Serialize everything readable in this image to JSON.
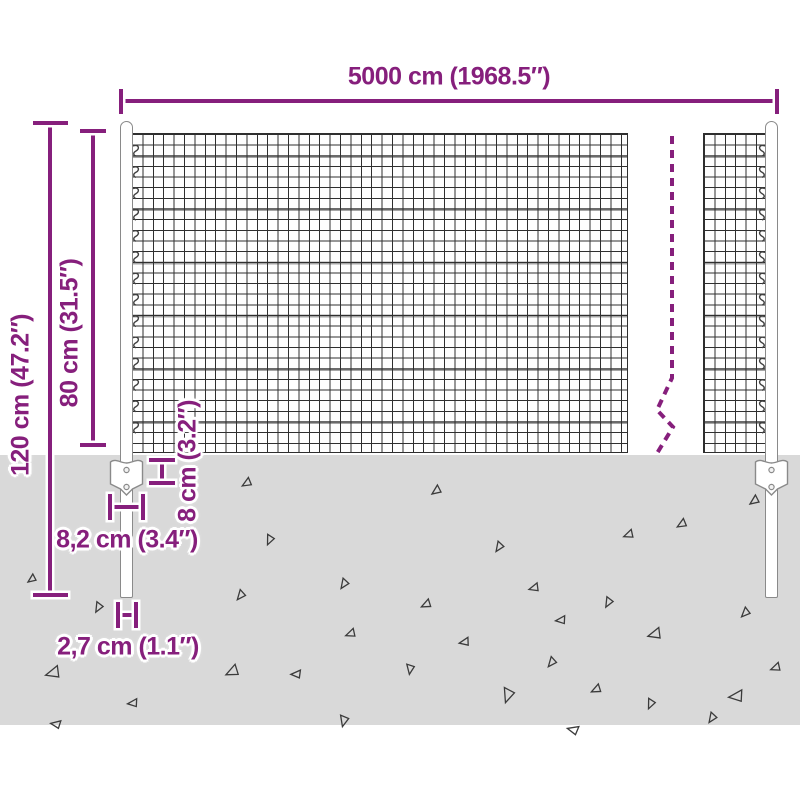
{
  "diagram": {
    "type": "product-dimension-diagram",
    "subject": "wire mesh fence with posts and anchor plates",
    "accent_color": "#861F7C",
    "ground_color": "#D9D9D9",
    "mesh_line_color": "#2F2F2F"
  },
  "labels": {
    "total_width": "5000 cm (1968.5″)",
    "post_height": "120 cm (47.2″)",
    "fence_height": "80 cm (31.5″)",
    "plate_height": "8 cm (3.2″)",
    "plate_width": "8,2 cm (3.4″)",
    "post_width": "2,7 cm (1.1″)"
  },
  "ground": {
    "triangles": [
      {
        "x": 28,
        "y": 574,
        "s": 8,
        "r": 0
      },
      {
        "x": 50,
        "y": 663,
        "s": 13,
        "r": 20
      },
      {
        "x": 57,
        "y": 717,
        "s": 9,
        "r": 45
      },
      {
        "x": 92,
        "y": 604,
        "s": 9,
        "r": -25
      },
      {
        "x": 132,
        "y": 696,
        "s": 9,
        "r": 30
      },
      {
        "x": 228,
        "y": 663,
        "s": 12,
        "r": 10
      },
      {
        "x": 235,
        "y": 591,
        "s": 9,
        "r": -15
      },
      {
        "x": 243,
        "y": 477,
        "s": 9,
        "r": 5
      },
      {
        "x": 263,
        "y": 537,
        "s": 9,
        "r": -30
      },
      {
        "x": 296,
        "y": 667,
        "s": 9,
        "r": 35
      },
      {
        "x": 338,
        "y": 580,
        "s": 9,
        "r": -20
      },
      {
        "x": 348,
        "y": 627,
        "s": 9,
        "r": 15
      },
      {
        "x": 336,
        "y": 719,
        "s": 10,
        "r": -40
      },
      {
        "x": 403,
        "y": 668,
        "s": 9,
        "r": -45
      },
      {
        "x": 423,
        "y": 598,
        "s": 9,
        "r": 10
      },
      {
        "x": 432,
        "y": 485,
        "s": 9,
        "r": 0
      },
      {
        "x": 463,
        "y": 635,
        "s": 9,
        "r": 25
      },
      {
        "x": 493,
        "y": 543,
        "s": 9,
        "r": -20
      },
      {
        "x": 498,
        "y": 692,
        "s": 13,
        "r": -35
      },
      {
        "x": 532,
        "y": 581,
        "s": 9,
        "r": 20
      },
      {
        "x": 546,
        "y": 658,
        "s": 9,
        "r": -15
      },
      {
        "x": 560,
        "y": 613,
        "s": 9,
        "r": 30
      },
      {
        "x": 575,
        "y": 722,
        "s": 10,
        "r": 50
      },
      {
        "x": 593,
        "y": 683,
        "s": 9,
        "r": 10
      },
      {
        "x": 602,
        "y": 599,
        "s": 9,
        "r": -25
      },
      {
        "x": 626,
        "y": 528,
        "s": 9,
        "r": 15
      },
      {
        "x": 644,
        "y": 701,
        "s": 9,
        "r": -30
      },
      {
        "x": 652,
        "y": 625,
        "s": 12,
        "r": 20
      },
      {
        "x": 678,
        "y": 518,
        "s": 9,
        "r": 5
      },
      {
        "x": 706,
        "y": 714,
        "s": 9,
        "r": -20
      },
      {
        "x": 735,
        "y": 686,
        "s": 13,
        "r": 30
      },
      {
        "x": 740,
        "y": 608,
        "s": 9,
        "r": -10
      },
      {
        "x": 750,
        "y": 495,
        "s": 9,
        "r": 0
      },
      {
        "x": 773,
        "y": 661,
        "s": 9,
        "r": 15
      }
    ]
  }
}
